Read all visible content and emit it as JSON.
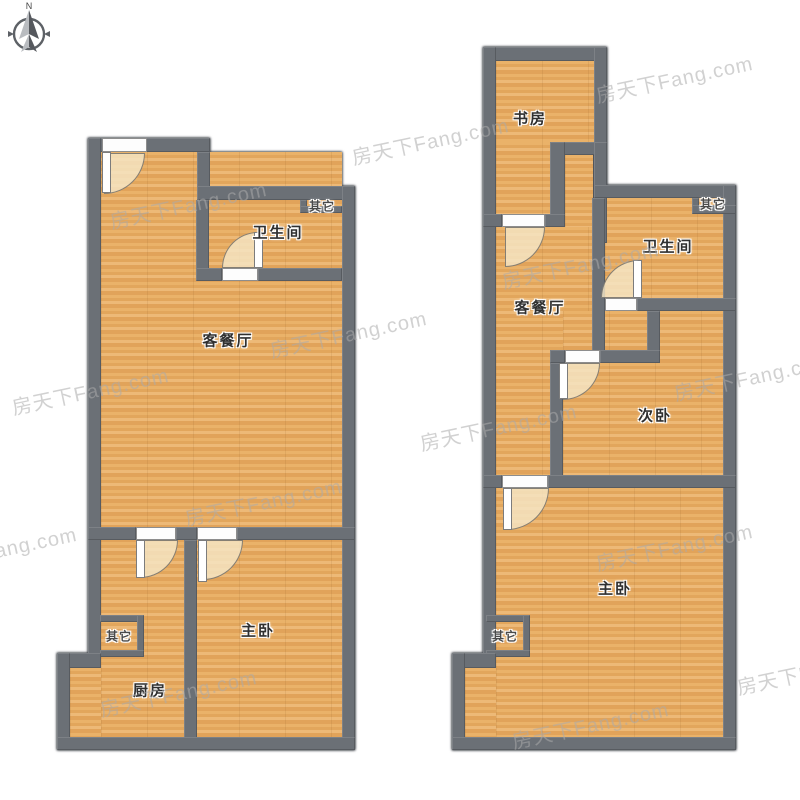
{
  "compass": {
    "north_label": "N"
  },
  "watermark": {
    "text": "房天下Fang.com"
  },
  "left_plan": {
    "rooms": {
      "living_dining": "客餐厅",
      "bathroom": "卫生间",
      "other_top_right": "其它",
      "master_bedroom": "主卧",
      "kitchen": "厨房",
      "other_left": "其它"
    }
  },
  "right_plan": {
    "rooms": {
      "study": "书房",
      "bathroom": "卫生间",
      "other_top_right": "其它",
      "living_dining": "客餐厅",
      "second_bedroom": "次卧",
      "master_bedroom": "主卧",
      "other_left": "其它"
    }
  },
  "colors": {
    "wall": "#6b7076",
    "wall_edge": "#4b4f55",
    "floor": "#e6ac63",
    "door_swing": "#f4e5c4",
    "watermark": "#acacac",
    "background": "#ffffff"
  }
}
